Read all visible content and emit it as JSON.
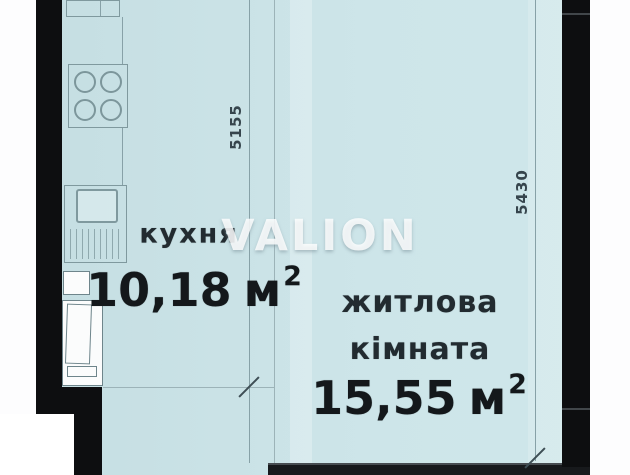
{
  "watermark": "VALION",
  "rooms": {
    "kitchen": {
      "name": "кухня",
      "area": "10,18",
      "unit": "м",
      "area_sup": "2"
    },
    "living": {
      "name_line1": "житлова",
      "name_line2": "кімната",
      "area": "15,55",
      "unit": "м",
      "area_sup": "2"
    }
  },
  "dimensions": {
    "kitchen_depth": "5155",
    "room_height": "5430"
  },
  "fixtures": {
    "stove": "stove-icon",
    "sink": "sink-icon",
    "drainer": "dish-drainer-icon",
    "cabinet": "cabinet-icon",
    "door": "door-icon"
  },
  "colors": {
    "floor": "#cbe3e7",
    "wall": "#0d0e10",
    "plan_line": "#87a1a7",
    "label_text": "#222b30",
    "area_text": "#14181b",
    "watermark_text": "#ffffff"
  }
}
